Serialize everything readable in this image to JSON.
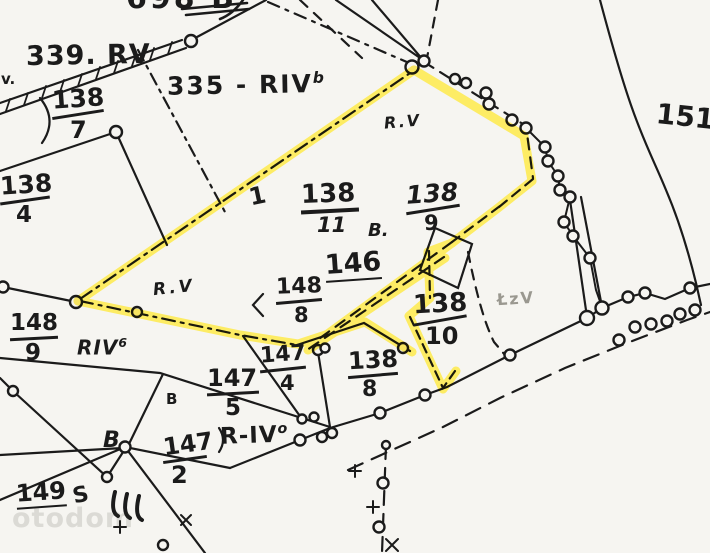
{
  "map_title": "cadastral parcel map with highlighted plot boundary",
  "colors": {
    "highlight": "#ffe93c",
    "ink": "#1b1b1b",
    "paper": "#f6f5f1",
    "faint_label": "#9a9890"
  },
  "watermark": "otodom",
  "labels": {
    "top_cut": "698 B",
    "p339": "339. RV",
    "v_edge": "v.",
    "p335": "335 - RIV",
    "p335_sup": "b",
    "one_mark": "1",
    "rv_top": "R.V",
    "rv_mid": "R.V",
    "b_dot": "B.",
    "p146": "146",
    "riv6": "RIV",
    "riv6_sup": "6",
    "lzv": "ŁzV",
    "p151": "151",
    "r_iv": "R-IV",
    "r_iv_sup": "o",
    "b_small": "B",
    "b_big": "B",
    "s_mark": "S",
    "p149": "149"
  },
  "fractions": {
    "f138_7": {
      "num": "138",
      "den": "7"
    },
    "f138_4": {
      "num": "138",
      "den": "4"
    },
    "f138_11": {
      "num": "138",
      "den": "11"
    },
    "f138_9": {
      "num": "138",
      "den": "9"
    },
    "f148_8": {
      "num": "148",
      "den": "8"
    },
    "f148_9": {
      "num": "148",
      "den": "9"
    },
    "f147_4": {
      "num": "147",
      "den": "4"
    },
    "f147_5": {
      "num": "147",
      "den": "5"
    },
    "f147_2": {
      "num": "147",
      "den": "2"
    },
    "f138_10": {
      "num": "138",
      "den": "10"
    },
    "f138_8b": {
      "num": "138",
      "den": "8"
    }
  }
}
